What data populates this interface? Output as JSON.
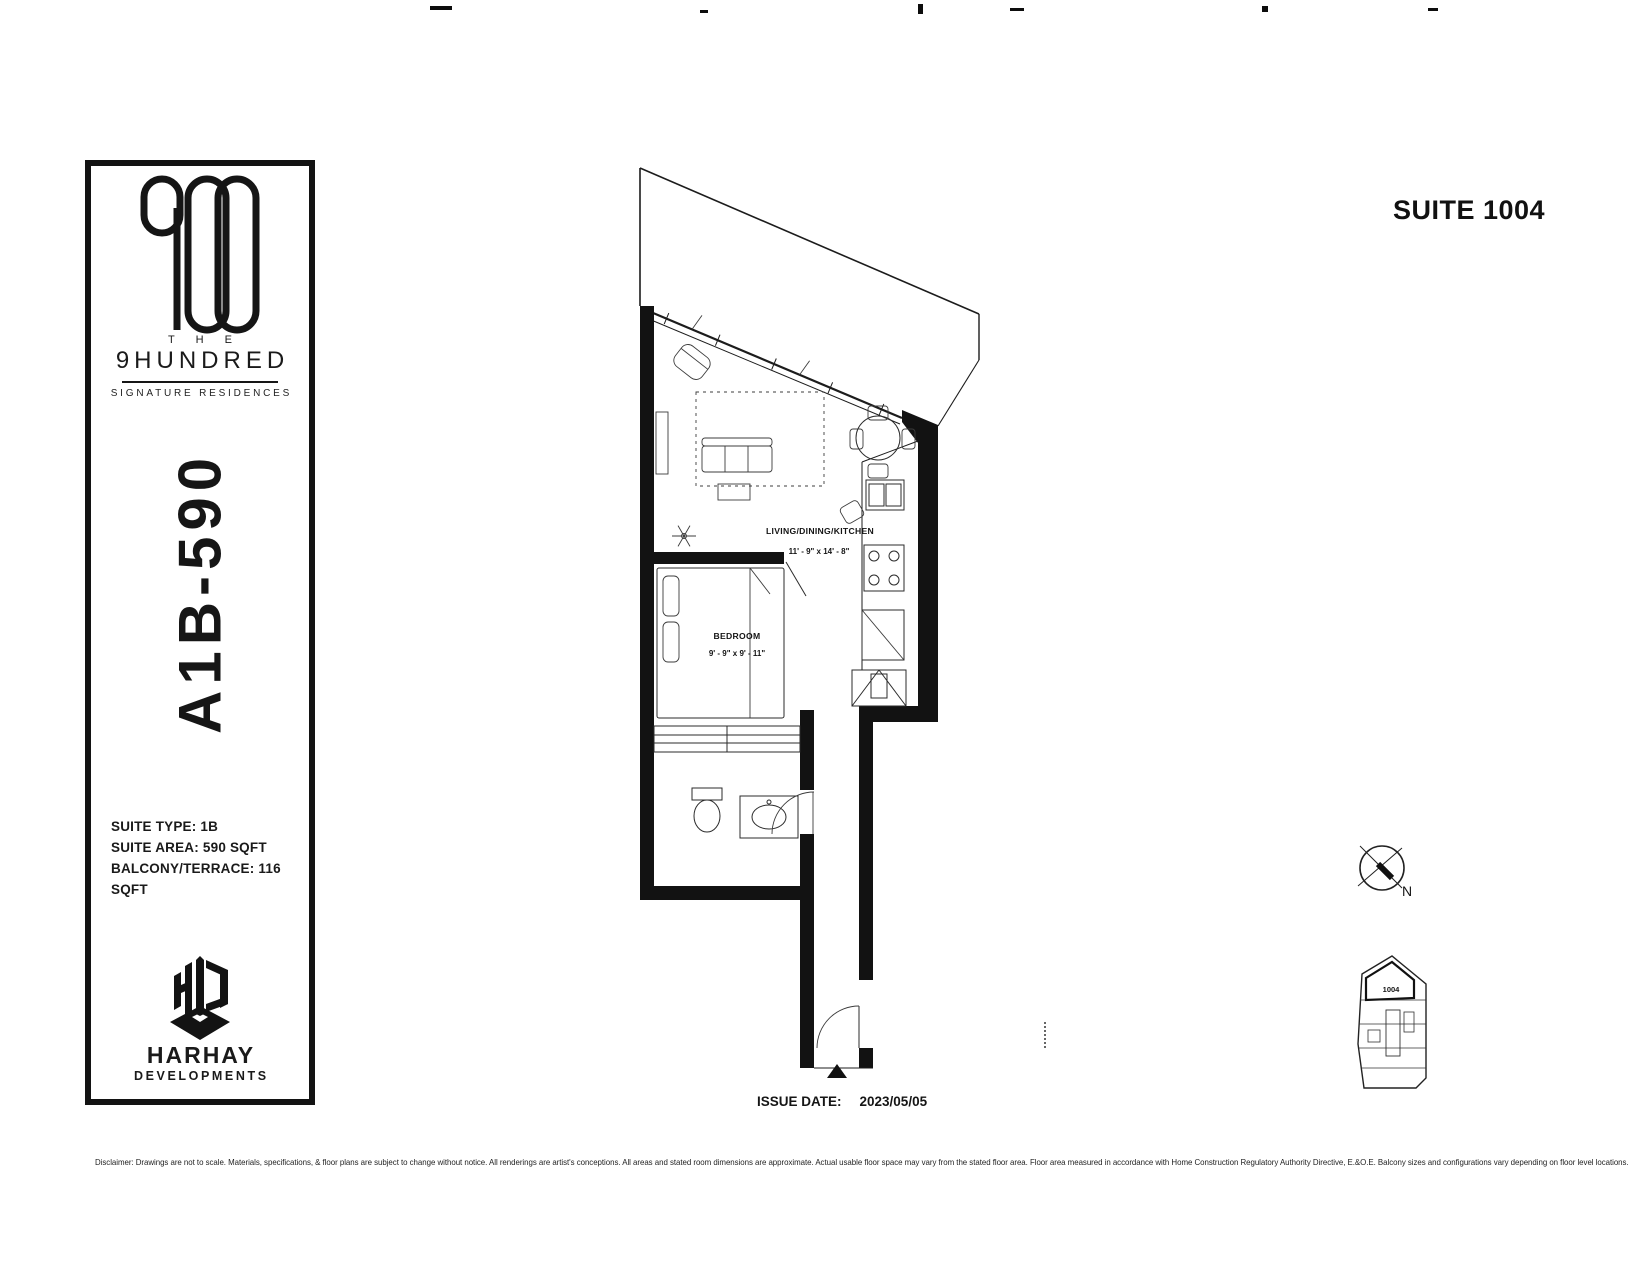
{
  "header": {
    "suite_title": "SUITE 1004"
  },
  "sidebar": {
    "brand": {
      "the": "T H E",
      "name": "9HUNDRED",
      "tagline": "SIGNATURE RESIDENCES"
    },
    "unit_code": "A1B-590",
    "details": [
      "SUITE TYPE: 1B",
      "SUITE AREA: 590 SQFT",
      "BALCONY/TERRACE: 116 SQFT"
    ],
    "developer": {
      "name": "HARHAY",
      "sub": "DEVELOPMENTS"
    }
  },
  "floorplan": {
    "rooms": [
      {
        "name": "LIVING/DINING/KITCHEN",
        "dims": "11' - 9\" x 14' - 8\""
      },
      {
        "name": "BEDROOM",
        "dims": "9' - 9\" x 9' - 11\""
      }
    ],
    "compass_label": "N",
    "keyplan_suite": "1004"
  },
  "footer": {
    "issue_date_label": "ISSUE DATE:",
    "issue_date_value": "2023/05/05",
    "disclaimer": "Disclaimer: Drawings are not to scale. Materials, specifications, & floor plans are subject to change without notice. All renderings are artist's conceptions. All areas and stated room dimensions are approximate. Actual usable floor space may vary from the stated floor area. Floor area measured in accordance with Home Construction Regulatory Authority Directive, E.&O.E. Balcony sizes and configurations vary depending on floor level locations."
  },
  "colors": {
    "ink": "#1a1a1a",
    "paper": "#ffffff"
  }
}
